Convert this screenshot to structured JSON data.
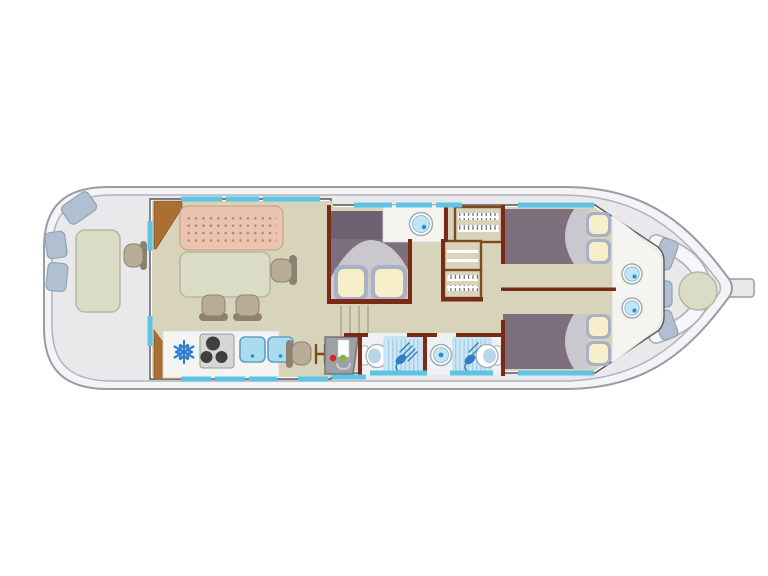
{
  "diagram": {
    "subject": "houseboat-floor-plan-top-view",
    "orientation": "bow-left-stern-right",
    "areas": {
      "bow_deck": {
        "features": [
          "seat-cushion",
          "seat-cushion",
          "seat-cushion",
          "deck-table",
          "helm-chair"
        ]
      },
      "saloon_galley": {
        "features": [
          "corner-cabinet",
          "corner-cabinet",
          "upholstered-bench",
          "dining-table",
          "dining-chair",
          "dining-chair",
          "dining-chair",
          "freezer",
          "three-burner-hob",
          "double-sink",
          "desk-chair",
          "magazine-rack"
        ]
      },
      "companionway": {
        "features": [
          "steps",
          "heater-unit-with-indicator-lights"
        ]
      },
      "midship_cabin": {
        "features": [
          "double-bed",
          "headboard-locker",
          "pillow",
          "pillow",
          "duvet",
          "vanity-counter",
          "washbasin"
        ]
      },
      "storage": {
        "features": [
          "hanging-wardrobe",
          "shelf-unit",
          "hanging-wardrobe"
        ]
      },
      "bathroom_forward": {
        "features": [
          "toilet",
          "shower"
        ]
      },
      "bathroom_aft": {
        "features": [
          "washbasin",
          "shower",
          "toilet"
        ]
      },
      "aft_cabin_port": {
        "features": [
          "double-bed",
          "duvet",
          "pillow",
          "pillow",
          "washbasin"
        ]
      },
      "aft_cabin_starboard": {
        "features": [
          "double-bed",
          "duvet",
          "pillow",
          "pillow",
          "washbasin"
        ]
      },
      "stern_deck": {
        "features": [
          "curved-bench",
          "seat-cushion",
          "seat-cushion",
          "seat-cushion",
          "round-table",
          "tiller"
        ]
      }
    },
    "window_count": 18
  },
  "palette": {
    "hull_fill": "#f4f4f6",
    "hull_stroke": "#9b9ba1",
    "deck_fill": "#e9e9ec",
    "deck_stroke": "#b3b3b9",
    "cabin_fill": "#fbfbfc",
    "cabin_stroke": "#55565c",
    "floor": "#d8d4bb",
    "wall": "#7b2a17",
    "wood": "#aa6f33",
    "wood_dark": "#7d4a1c",
    "bench_pink": "#eac4b1",
    "bench_dot": "#bb8a70",
    "bench_border": "#cfa28b",
    "table_fill": "#dbdcc6",
    "table_stroke": "#b5b7a0",
    "chair_fill": "#b9ac96",
    "chair_stroke": "#8d8271",
    "bed_purple": "#7d6f7b",
    "bed_dark": "#6e6270",
    "duvet": "#cac8ce",
    "pillow_frame": "#a7b3c4",
    "pillow_fill": "#f6efca",
    "window": "#5ec4e6",
    "cushion": "#b0c0d0",
    "cushion_stroke": "#8fa3b5",
    "counter": "#f4f4f1",
    "hob_fill": "#d6d6d6",
    "burner": "#3f3f3f",
    "sink_fill": "#aadcef",
    "sink_stroke": "#5f9ec2",
    "shower_fill": "#cde8f4",
    "shower_line": "#9fcbe4",
    "shower_icon": "#2f7fc0",
    "fixture_ring": "#a5abb2",
    "fixture_fill": "#c2e5f4",
    "fixture_dot": "#2590c4",
    "toilet_fill": "#b7d7e8",
    "heater_fill": "#9fa0a6",
    "heater_stroke": "#74757b",
    "indicator_red": "#d42a1e",
    "indicator_green": "#7fb832",
    "snowflake": "#2e7fd0",
    "step_line": "#aaa690"
  }
}
